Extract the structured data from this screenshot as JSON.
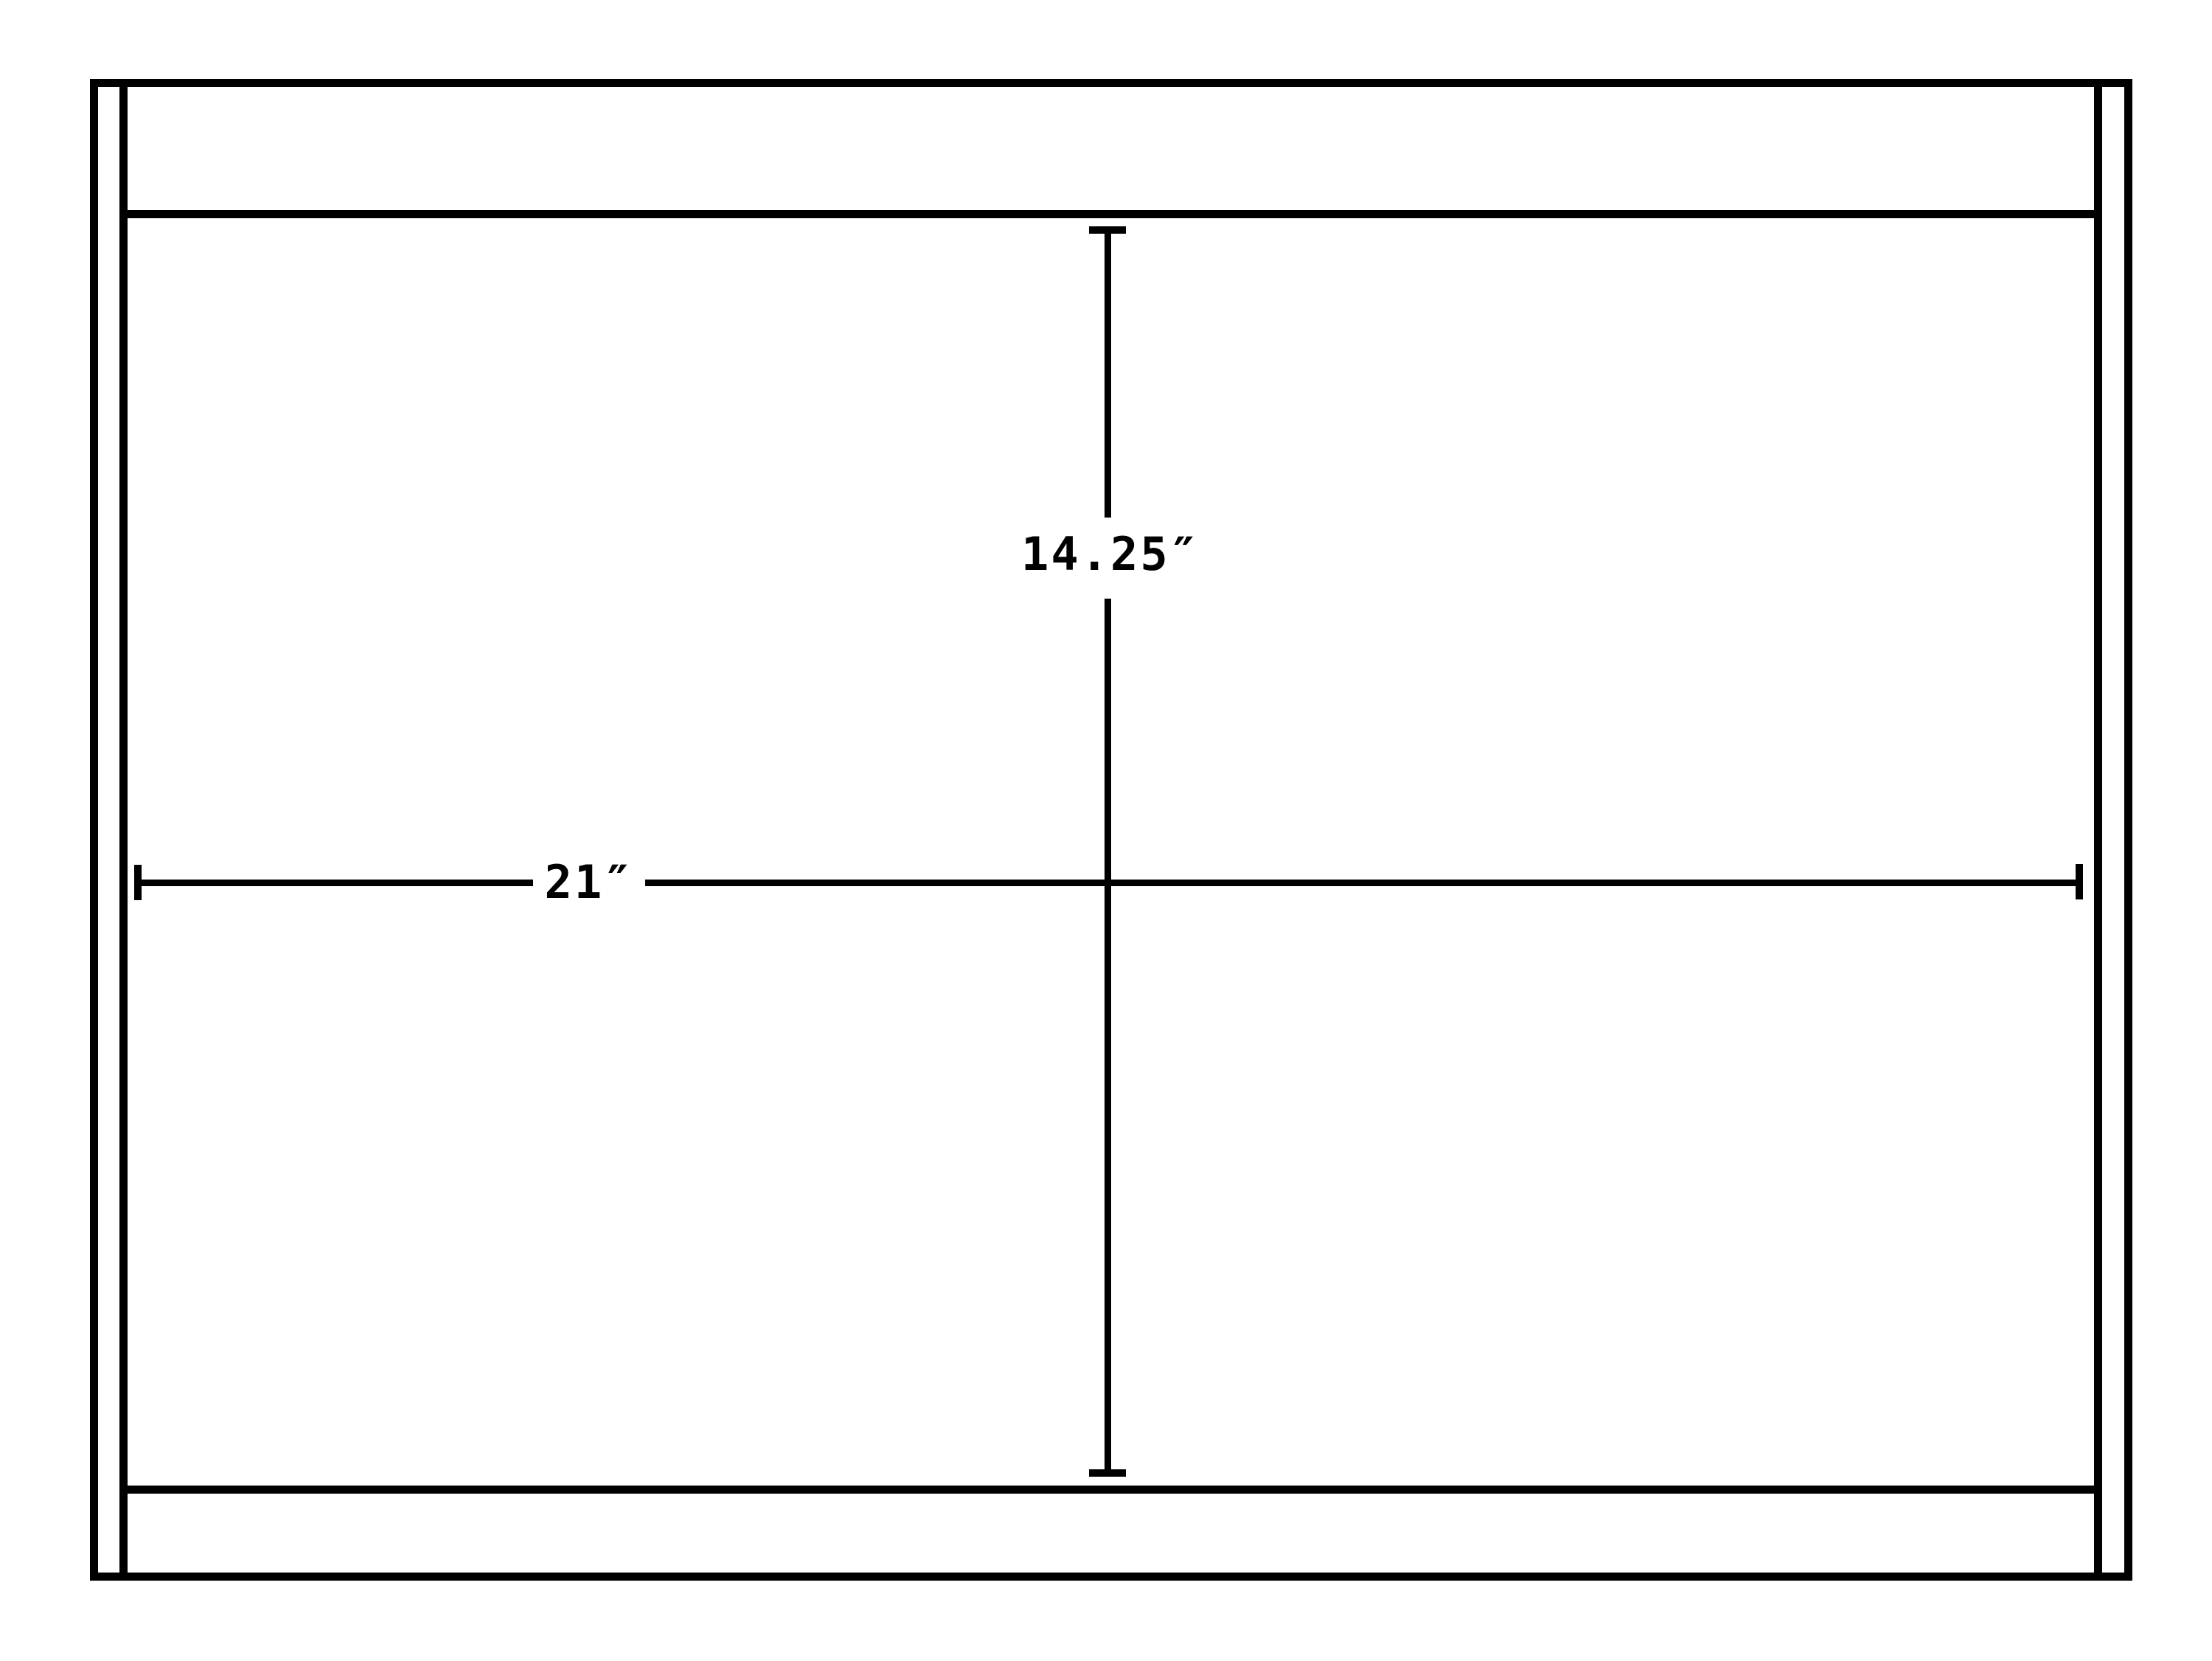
{
  "diagram": {
    "type": "technical-dimension-drawing",
    "background_color": "#ffffff",
    "line_color": "#000000",
    "dimensions": {
      "width": {
        "label": "21″",
        "value": 21,
        "unit": "inches",
        "orientation": "horizontal"
      },
      "height": {
        "label": "14.25″",
        "value": 14.25,
        "unit": "inches",
        "orientation": "vertical"
      }
    }
  }
}
